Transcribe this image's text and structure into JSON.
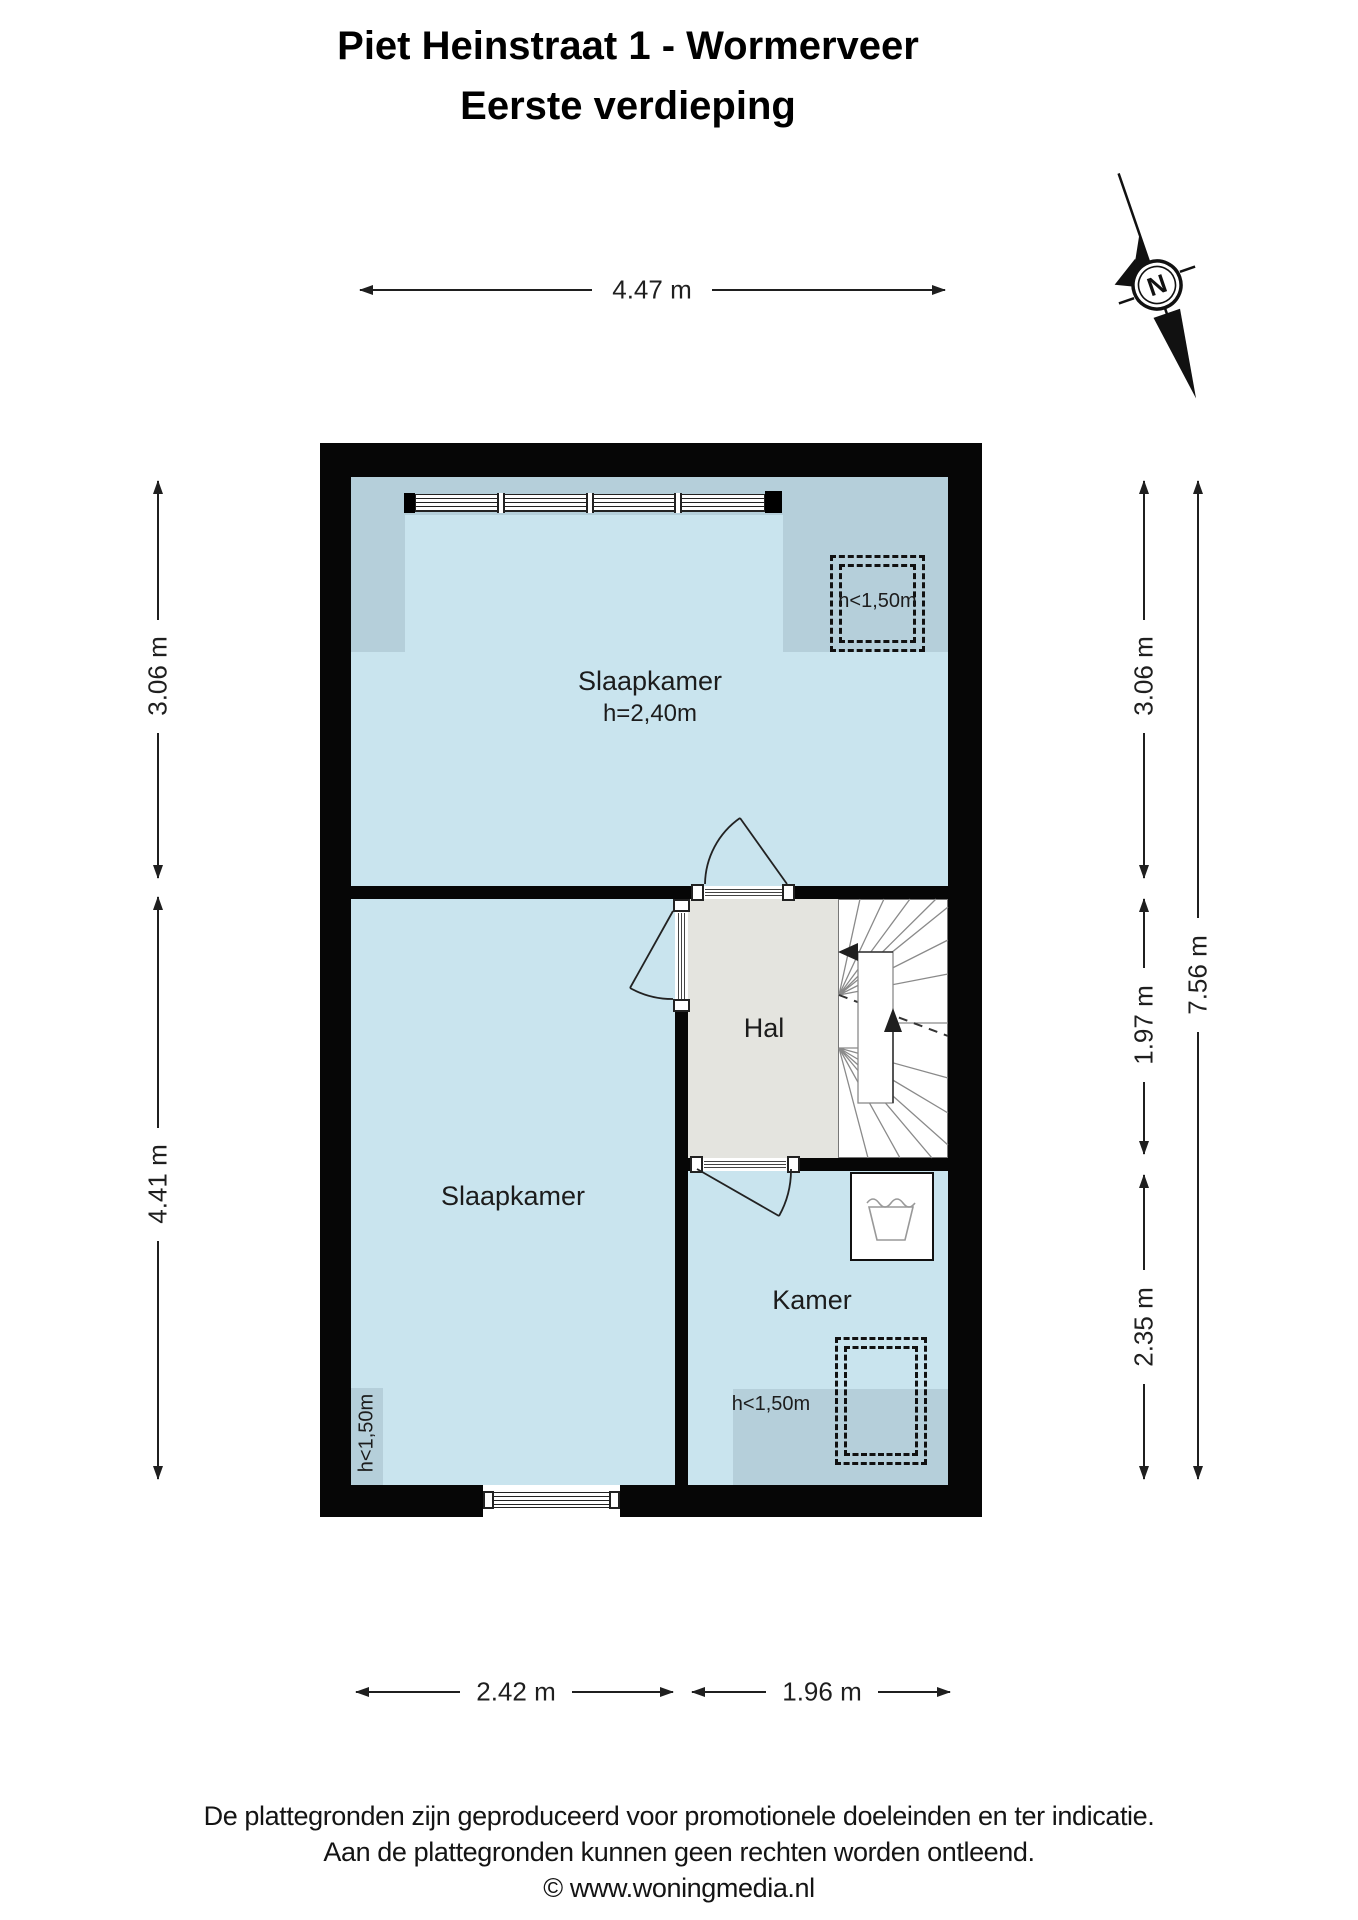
{
  "title": {
    "line1": "Piet Heinstraat 1 - Wormerveer",
    "line2": "Eerste verdieping"
  },
  "compass": {
    "letter": "N"
  },
  "rooms": {
    "slaapkamer_top": {
      "label": "Slaapkamer",
      "height_note": "h=2,40m"
    },
    "slaapkamer_bottom": {
      "label": "Slaapkamer"
    },
    "hal": {
      "label": "Hal"
    },
    "kamer": {
      "label": "Kamer"
    }
  },
  "low_height_labels": {
    "top_room": "h<1,50m",
    "bottom_room": "h<1,50m",
    "kamer": "h<1,50m"
  },
  "dimensions": {
    "top_width": "4.47 m",
    "left_upper": "3.06 m",
    "left_lower": "4.41 m",
    "right_upper": "3.06 m",
    "right_middle": "1.97 m",
    "right_lower": "2.35 m",
    "right_total": "7.56 m",
    "bottom_left": "2.42 m",
    "bottom_right": "1.96 m"
  },
  "colors": {
    "wall": "#060606",
    "room_fill": "#c9e4ee",
    "low_height_fill": "#b5cfda",
    "hall_fill": "#e4e4df"
  },
  "footer": {
    "line1": "De plattegronden zijn geproduceerd voor promotionele doeleinden en ter indicatie.",
    "line2": "Aan de plattegronden kunnen geen rechten worden ontleend.",
    "line3": "© www.woningmedia.nl"
  }
}
